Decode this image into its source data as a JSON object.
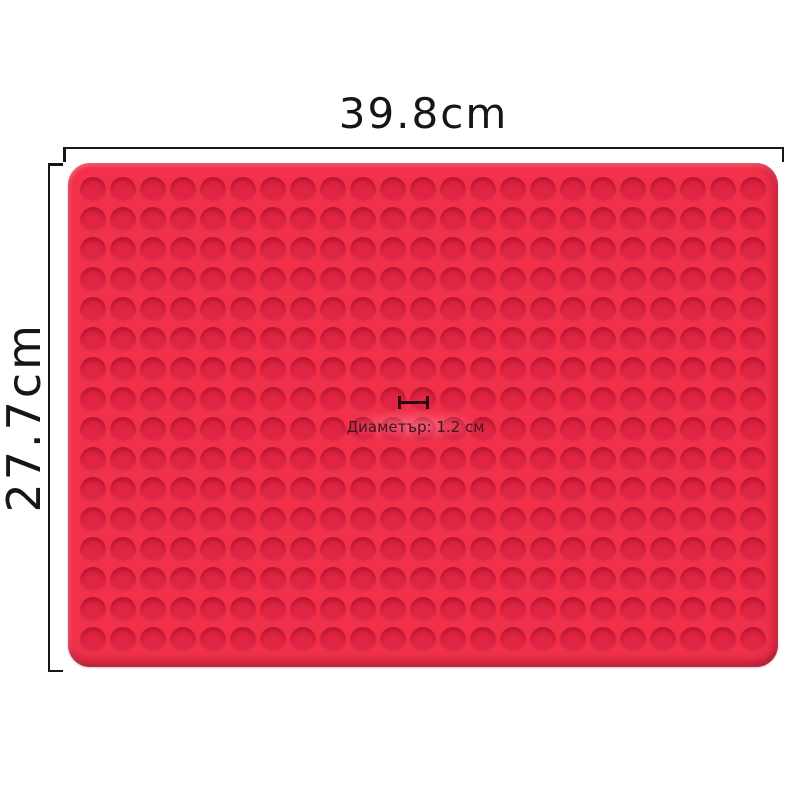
{
  "dimensions": {
    "width_label": "39.8cm",
    "height_label": "27.7cm",
    "diameter_label": "Диаметър: 1.2 см"
  },
  "mat": {
    "pattern": {
      "rows": 16,
      "cols": 23
    }
  },
  "colors": {
    "mat_base": "#f23049",
    "bump": "#e02443",
    "bump_rim": "#c21a38",
    "dimension_line": "#161616",
    "diameter_text": "#43141d",
    "diameter_marker": "#2e070e",
    "background": "#ffffff"
  }
}
